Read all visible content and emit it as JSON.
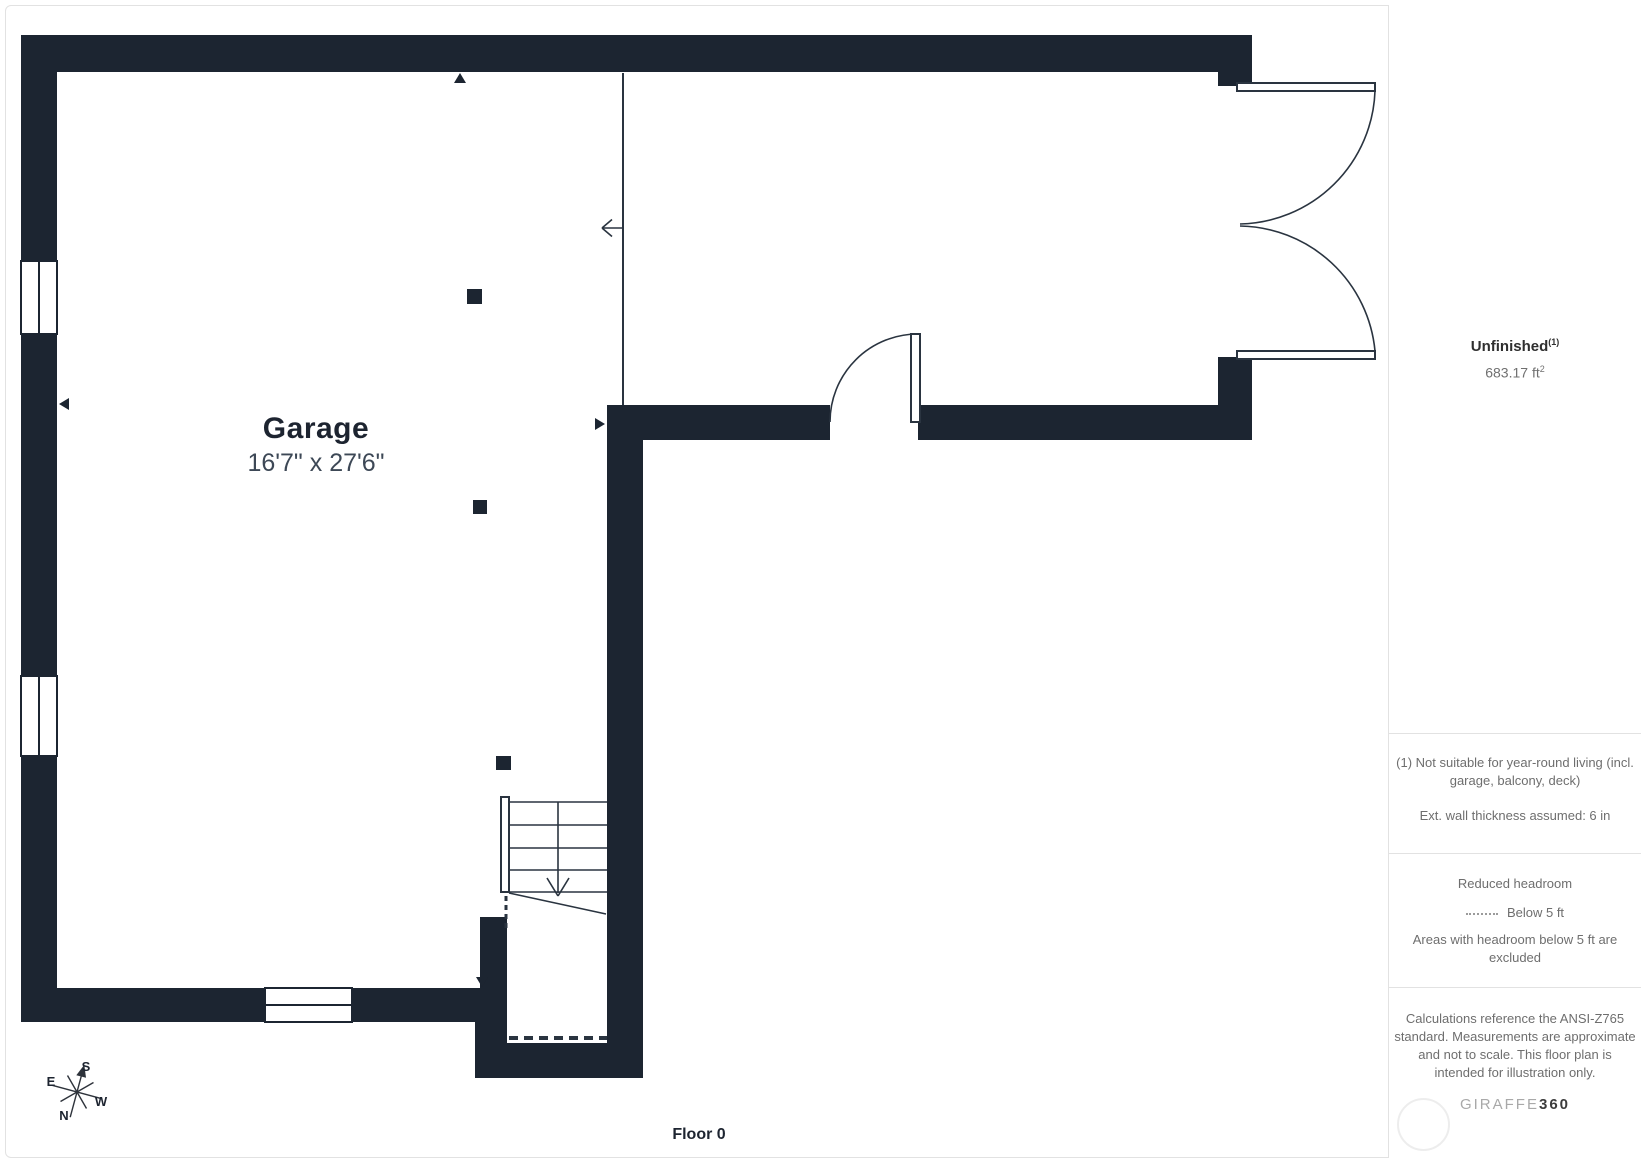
{
  "plan": {
    "room_label": "Garage",
    "room_dimensions": "16'7\" x 27'6\"",
    "floor_label": "Floor 0"
  },
  "compass": {
    "north": "N",
    "south": "S",
    "east": "E",
    "west": "W"
  },
  "sidebar": {
    "area": {
      "name": "Unfinished",
      "footnote_marker": "(1)",
      "value_text": "683.17 ft",
      "exponent": "2"
    },
    "footnote": "(1) Not suitable for year-round living (incl. garage, balcony, deck)",
    "wall_thickness_note": "Ext. wall thickness assumed: 6 in",
    "headroom": {
      "title": "Reduced headroom",
      "legend_label": "Below 5 ft",
      "description": "Areas with headroom below 5 ft are excluded"
    },
    "disclaimer": "Calculations reference the ANSI-Z765 standard. Measurements are approximate and not to scale. This floor plan is intended for illustration only.",
    "logo": {
      "part1": "GIRAFFE",
      "part2": "360"
    }
  },
  "colors": {
    "wall": "#1c2531",
    "line": "#2a3440",
    "panel_border": "#e2e2e2",
    "text_dark": "#1d2430",
    "text_muted": "#6e6e6e"
  }
}
